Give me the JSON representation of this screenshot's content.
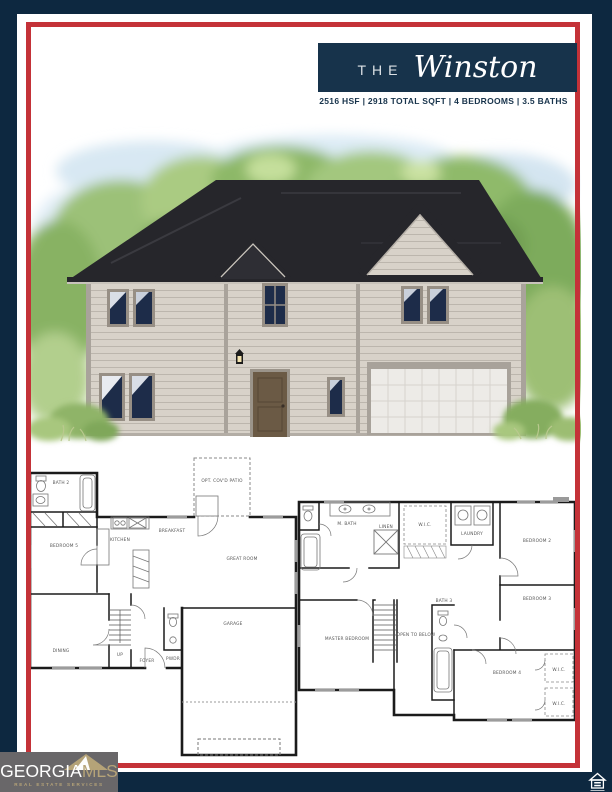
{
  "header": {
    "prefix": "THE",
    "plan_name": "Winston",
    "stats": "2516 HSF | 2918 TOTAL SQFT | 4 BEDROOMS | 3.5 BATHS"
  },
  "floorplans": {
    "first_floor": {
      "labels": {
        "patio": "OPT. COV'D PATIO",
        "bath2": "BATH 2",
        "bedroom5": "BEDROOM 5",
        "kitchen": "KITCHEN",
        "breakfast": "BREAKFAST",
        "great_room": "GREAT ROOM",
        "dining": "DINING",
        "foyer": "FOYER",
        "powder": "PWDR",
        "garage": "GARAGE",
        "stairs_up": "UP"
      }
    },
    "second_floor": {
      "labels": {
        "master_bath": "M. BATH",
        "linen": "LINEN",
        "wic": "W.I.C.",
        "laundry": "LAUNDRY",
        "bedroom2": "BEDROOM 2",
        "bedroom3": "BEDROOM 3",
        "bedroom4": "BEDROOM 4",
        "master_bedroom": "MASTER BEDROOM",
        "open_to_below": "OPEN TO BELOW",
        "bath3": "BATH 3",
        "wic_a": "W.I.C.",
        "wic_b": "W.I.C."
      }
    }
  },
  "footer": {
    "logo": {
      "name_part1": "GEORGIA",
      "name_part2": "MLS",
      "tagline": "REAL ESTATE SERVICES"
    },
    "icons": {
      "equal_housing": "equal-housing-icon",
      "mls_mountain": "mountain-icon"
    }
  },
  "colors": {
    "frame_navy": "#0d2840",
    "accent_red": "#c43238",
    "header_navy": "#17334b",
    "logo_gray": "#696769",
    "logo_gold": "#b5a378"
  }
}
